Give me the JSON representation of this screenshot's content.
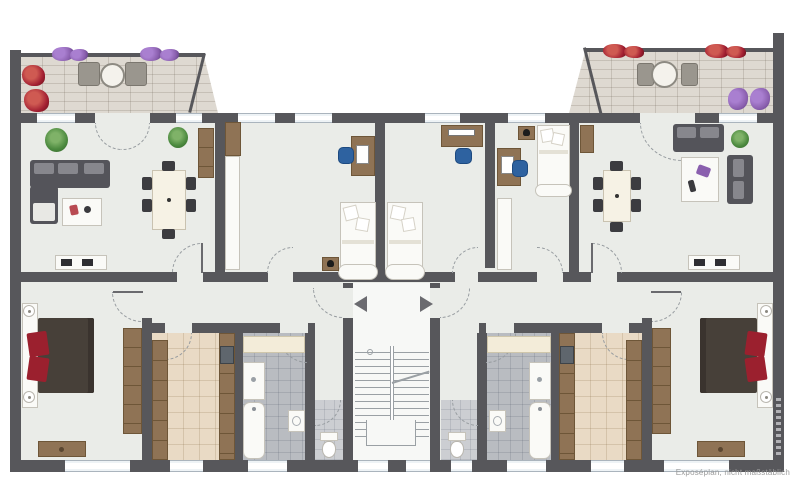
{
  "plan": {
    "caption": "Exposéplan, nicht maßstäblich"
  },
  "colors": {
    "wall": "#57575b",
    "floor": "#eaece8",
    "floor-stair": "#f7f8f6",
    "kitchen-floor": "#e9dac5",
    "bath-floor": "#b9bcc1",
    "wc-floor": "#ccced2",
    "balcony-floor": "#ded9d1",
    "window-line": "#aab4bd",
    "furn-brown": "#8f7355",
    "furn-brown-dark": "#6e5638",
    "sofa": "#54545a",
    "sofa-light": "#87878d",
    "bed-dark": "#474039",
    "accent-red": "#9b202e",
    "chair-dark": "#3c3c40",
    "chair-blue": "#2e62a0",
    "plant": "#4c8a3f",
    "flower-purple": "#8a5fae",
    "flower-red": "#a21f32",
    "arc": "#979ca0",
    "stair-line": "#9aa0a4",
    "arrow": "#6b6b70",
    "caption": "#9a9a9a"
  },
  "apartments": [
    {
      "id": "apartment-left",
      "rooms": [
        {
          "name": "balcony",
          "furniture": [
            "round-table",
            "two-chairs",
            "flower-boxes"
          ]
        },
        {
          "name": "living-dining-room",
          "furniture": [
            "corner-sofa",
            "rug",
            "dining-table",
            "six-chairs",
            "floor-plant",
            "potted-plant",
            "tall-cabinet",
            "tv-lowboard"
          ]
        },
        {
          "name": "kids-room",
          "furniture": [
            "single-bed",
            "desk",
            "desk-chair",
            "wardrobe-brown",
            "wardrobe-white",
            "nightstand"
          ]
        },
        {
          "name": "bedroom",
          "furniture": [
            "double-bed",
            "bedside-lamps",
            "wardrobe",
            "dresser"
          ]
        },
        {
          "name": "kitchen",
          "furniture": [
            "counter-left",
            "counter-right",
            "sink"
          ]
        },
        {
          "name": "bathroom",
          "furniture": [
            "vanity",
            "shower",
            "bathtub",
            "washbasin"
          ]
        },
        {
          "name": "wc",
          "furniture": [
            "toilet"
          ]
        },
        {
          "name": "hallway",
          "furniture": []
        }
      ]
    },
    {
      "id": "apartment-right",
      "rooms": [
        {
          "name": "balcony",
          "furniture": [
            "round-table",
            "two-chairs",
            "flower-boxes",
            "flower-pots"
          ]
        },
        {
          "name": "living-dining-room",
          "furniture": [
            "sofa",
            "sofa-2",
            "rug",
            "dining-table",
            "six-chairs",
            "floor-plant",
            "sideboard",
            "tv-lowboard"
          ]
        },
        {
          "name": "kids-room-1",
          "furniture": [
            "single-bed",
            "desk",
            "desk-chair"
          ]
        },
        {
          "name": "kids-room-2",
          "furniture": [
            "single-bed",
            "desk",
            "desk-chair",
            "wardrobe-white",
            "nightstand"
          ]
        },
        {
          "name": "bedroom",
          "furniture": [
            "double-bed",
            "bedside-lamps",
            "wardrobe",
            "dresser"
          ]
        },
        {
          "name": "kitchen",
          "furniture": [
            "counter-left",
            "counter-right",
            "sink"
          ]
        },
        {
          "name": "bathroom",
          "furniture": [
            "vanity",
            "shower",
            "bathtub",
            "washbasin"
          ]
        },
        {
          "name": "wc",
          "furniture": [
            "toilet"
          ]
        },
        {
          "name": "hallway",
          "furniture": []
        }
      ]
    }
  ],
  "shared_areas": [
    {
      "name": "stairwell",
      "features": [
        "staircase",
        "entrance-door-left",
        "entrance-door-right",
        "direction-arrow-left",
        "direction-arrow-right"
      ]
    }
  ]
}
